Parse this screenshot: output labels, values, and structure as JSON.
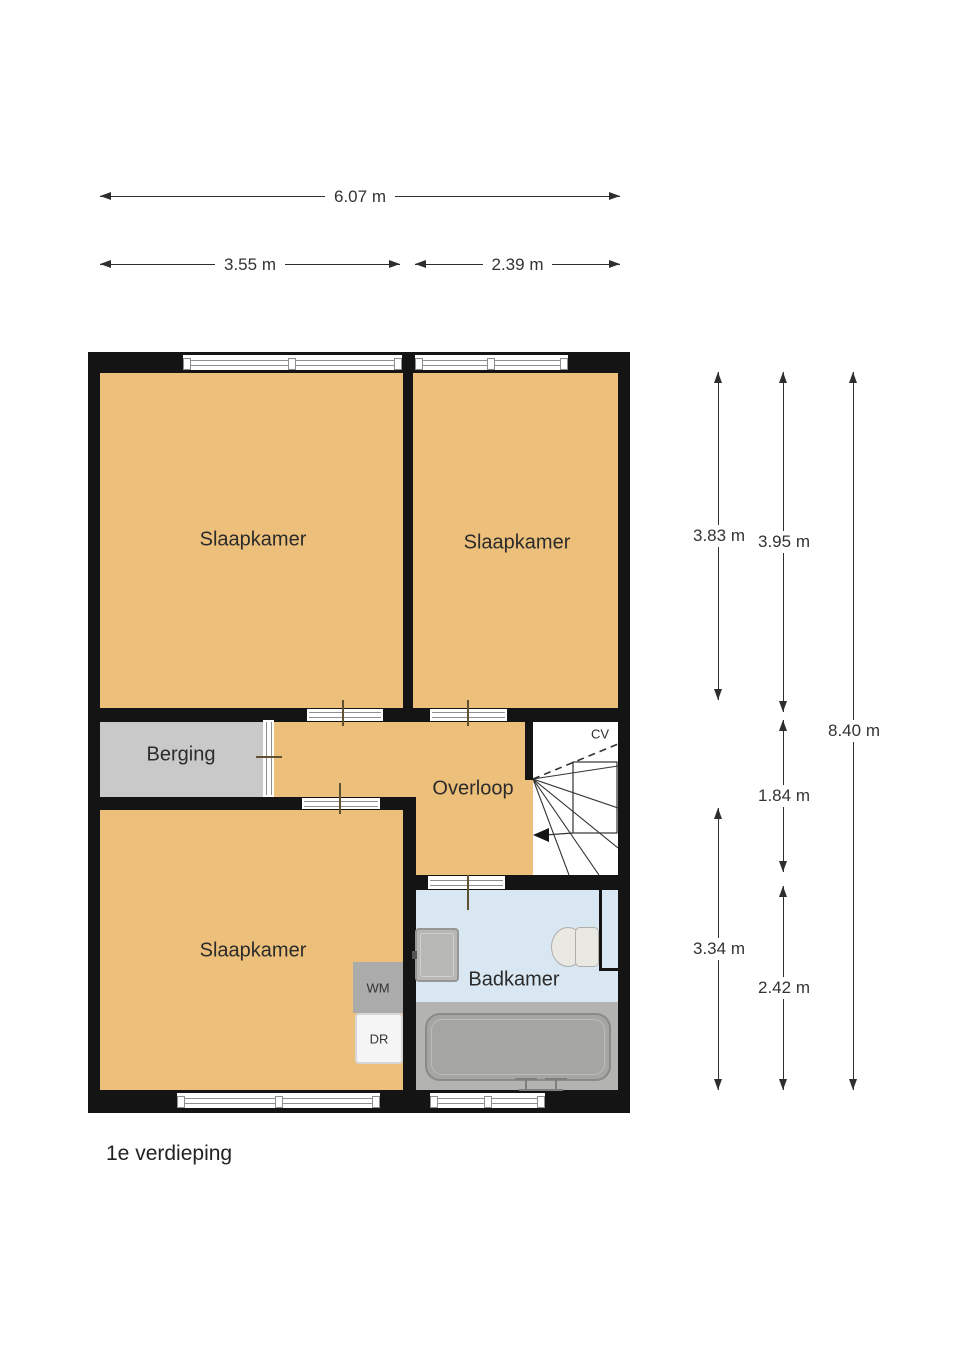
{
  "floor_label": "1e verdieping",
  "dims": {
    "total_width": "6.07 m",
    "left_width": "3.55 m",
    "right_width": "2.39 m",
    "bedroom_left_height": "3.83 m",
    "bedroom_right_height": "3.95 m",
    "landing_height": "1.84 m",
    "bathroom_height": "2.42 m",
    "bottom_bedroom_height": "3.34 m",
    "total_height": "8.40 m"
  },
  "rooms": {
    "bedroom_top_left": "Slaapkamer",
    "bedroom_top_right": "Slaapkamer",
    "storage": "Berging",
    "landing": "Overloop",
    "bedroom_bottom": "Slaapkamer",
    "bathroom": "Badkamer"
  },
  "appliances": {
    "washing_machine": "WM",
    "dryer": "DR",
    "boiler": "CV"
  },
  "colors": {
    "room_fill": "#ecc07a",
    "storage_fill": "#c9c9c9",
    "bathroom_fill": "#d8e7f2",
    "bath_platform": "#b3b3b1",
    "wall": "#141414"
  }
}
